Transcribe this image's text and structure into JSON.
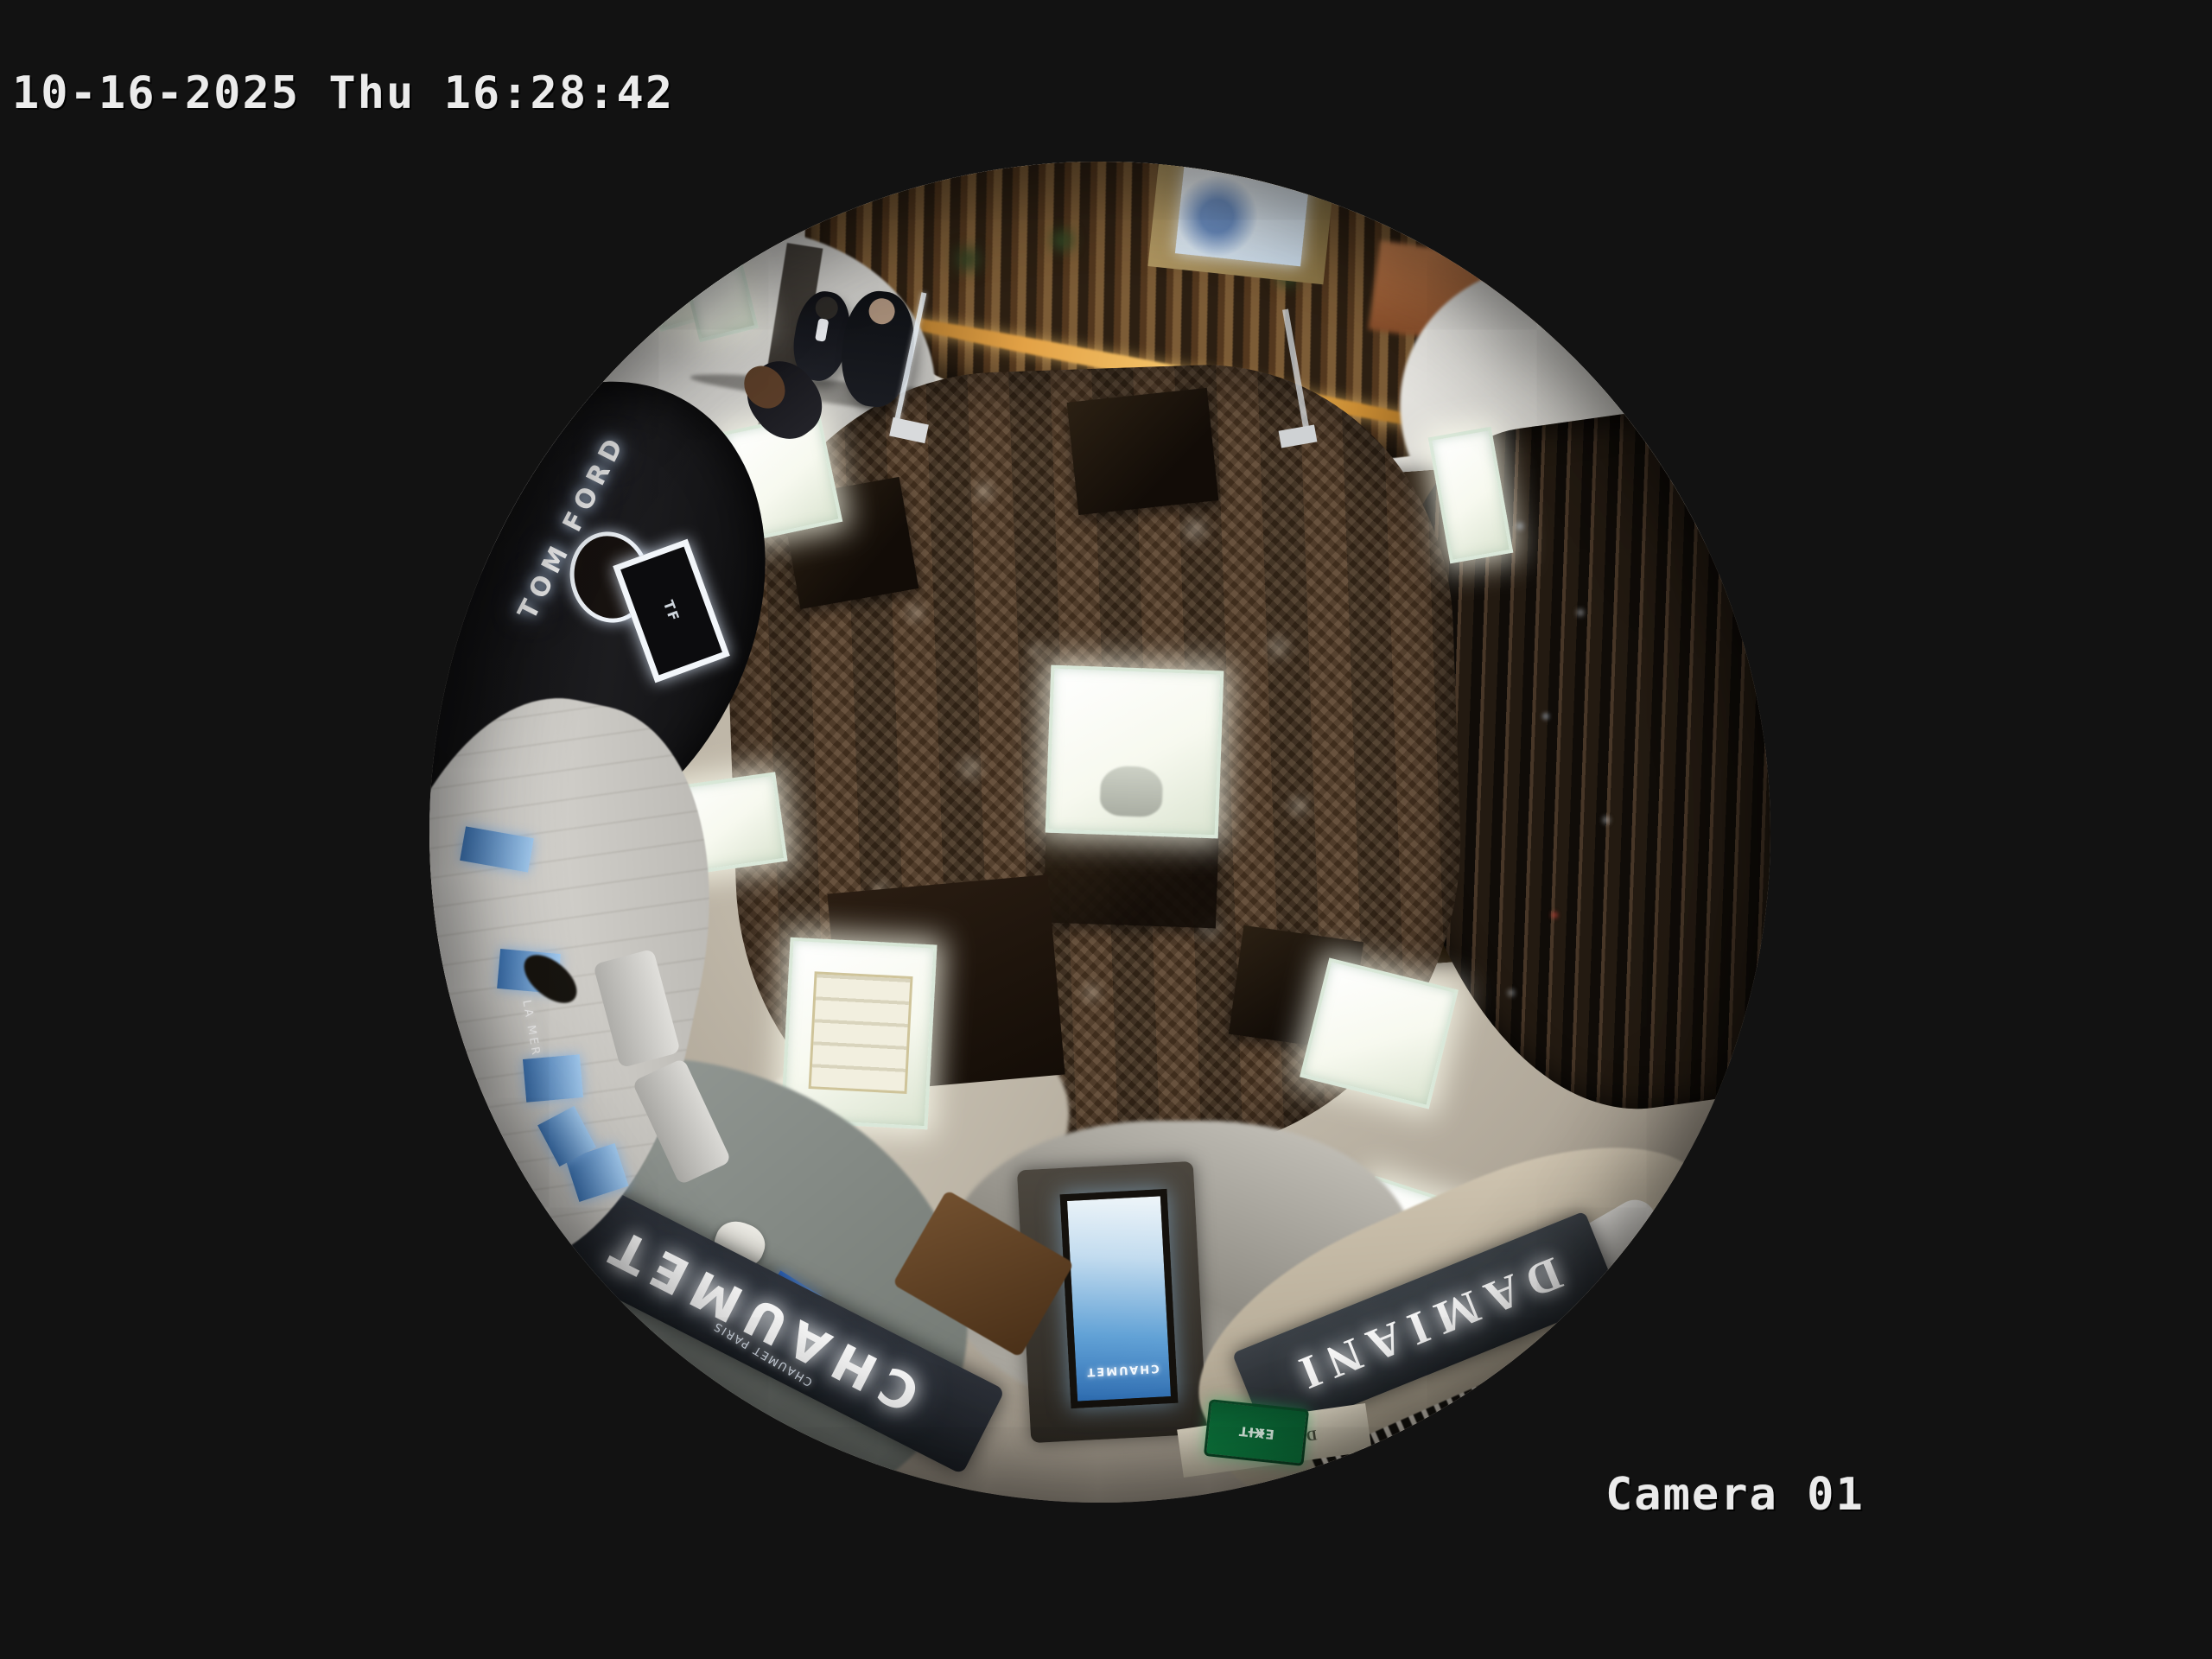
{
  "osd": {
    "timestamp": "10-16-2025 Thu 16:28:42",
    "camera_label": "Camera 01"
  },
  "signs": {
    "chaumet_fascia": "CHAUMET",
    "chaumet_boutique_small": "CHAUMET PARIS",
    "chaumet_kiosk_screen": "CHAUMET",
    "damiani_fascia": "DAMIANI",
    "damiani_lintel": "DAMIANI",
    "tom_ford_storefront": "TOM FORD",
    "tom_ford_monogram": "TF",
    "la_mer_counter": "LA MER",
    "exit_sign_text": "EXIT",
    "exit_sign_arrow": "←"
  },
  "scene": {
    "description": "Overhead fisheye CCTV view of a jewellery boutique with herringbone wood floor, lit display vitrines, mall corridor at top and brand fascias at bottom",
    "people_visible": 3
  },
  "palette": {
    "background": "#121212",
    "osd_text": "#ebebeb",
    "wood_floor": "#46321f",
    "stone_floor": "#c2bbac",
    "fascia_dark": "#23272e",
    "sign_glow": "#ffffff",
    "gold_trim": "#d8a14e",
    "exit_green": "#0c7a3e",
    "screen_blue": "#4f8fc9"
  }
}
